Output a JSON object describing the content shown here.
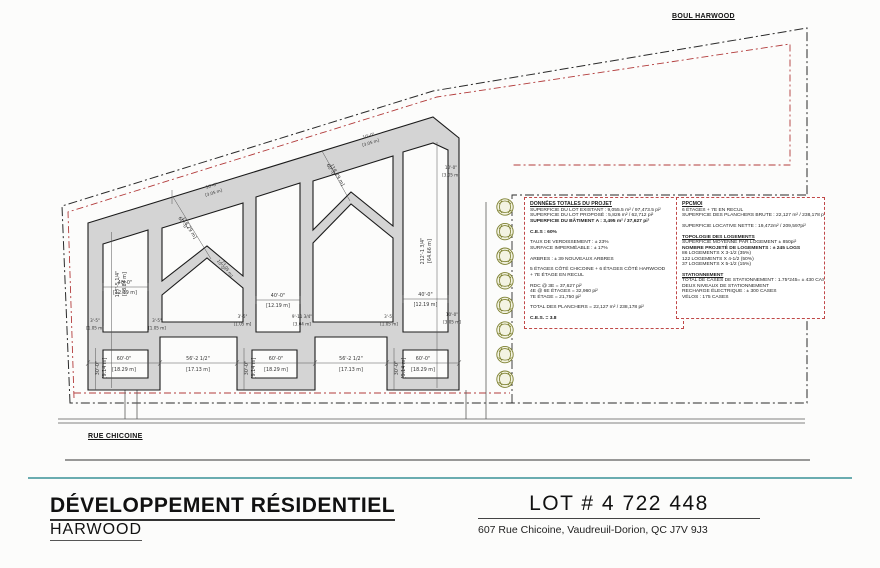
{
  "streets": {
    "harwood": "BOUL HARWOOD",
    "chicoine": "RUE CHICOINE"
  },
  "title_block": {
    "title": "DÉVELOPPEMENT RÉSIDENTIEL",
    "subtitle": "HARWOOD",
    "lot": "LOT # 4 722 448",
    "address": "607 Rue Chicoine, Vaudreuil-Dorion, QC J7V 9J3"
  },
  "colors": {
    "slab_gray": "#d4d4d4",
    "line_dark": "#1b1b1b",
    "red_line": "#b23b3b",
    "teal_line": "#6aacb0",
    "tree_olive": "#7d8030"
  },
  "info_left": {
    "title": "DONNÉES TOTALES DU PROJET",
    "lines": [
      {
        "t": "SUPERFICIE DU LOT EXISTANT : 9,055.5 m² / 97,473.5 pi²"
      },
      {
        "t": "SUPERFICIE DU LOT PROPOSÉ : 5,826 m² / 62,712 pi²"
      },
      {
        "t": "SUPERFICIE DU BÂTIMENT A : 3,495 m² / 37,627 pi²",
        "b": true
      },
      {
        "t": ""
      },
      {
        "t": "C.E.S : 60%",
        "b": true
      },
      {
        "t": ""
      },
      {
        "t": "TAUX DE VERDISSEMENT : ± 23%"
      },
      {
        "t": "SURFACE IMPERMÉABLE : ± 17%"
      },
      {
        "t": ""
      },
      {
        "t": "ARBRES : ± 39 NOUVEAUX ARBRES"
      },
      {
        "t": ""
      },
      {
        "t": "5 ÉTAGES CÔTÉ CHICOINE + 6 ÉTAGES CÔTÉ HARWOOD"
      },
      {
        "t": "+ 7E ÉTAGE EN RECUL"
      },
      {
        "t": ""
      },
      {
        "t": "RDC @ 3E = 37,627 pi²"
      },
      {
        "t": "4E @ 6E ÉTAGES = 32,960 pi²"
      },
      {
        "t": "7E ÉTAGE = 21,750 pi²"
      },
      {
        "t": ""
      },
      {
        "t": "TOTAL DES PLANCHERS = 22,127 m² / 238,178 pi²"
      },
      {
        "t": ""
      },
      {
        "t": "C.E.S. = 3.8",
        "b": true
      }
    ]
  },
  "info_right": {
    "title": "PPCMOI",
    "lines": [
      {
        "t": "6 ÉTAGES + 7E EN RECUL"
      },
      {
        "t": "SUPERFICIE DES PLANCHERS BRUTE : 22,127 m² / 238,178 pi²"
      },
      {
        "t": ""
      },
      {
        "t": "SUPERFICIE LOCATIVE NETTE : 19,472m² / 209,597pi²"
      },
      {
        "t": ""
      },
      {
        "t": "TOPOLOGIE DES LOGEMENTS",
        "b": true,
        "u": true
      },
      {
        "t": "SUPERFICIE MOYENNE PAR LOGEMENT ± 850pi²"
      },
      {
        "t": "NOMBRE PROJETÉ DE LOGEMENTS : ± 245 LOGS",
        "b": true
      },
      {
        "t": "86 LOGEMENTS X 3-1/2 (35%)"
      },
      {
        "t": "122 LOGEMENTS X 4-1/2 (50%)"
      },
      {
        "t": "37 LOGEMENTS X 5-1/2 (15%)"
      },
      {
        "t": ""
      },
      {
        "t": "STATIONNEMENT",
        "b": true,
        "u": true
      },
      {
        "t": "TOTAL DE CASES DE STATIONNEMENT : 1.75*245= ± 430 CASES"
      },
      {
        "t": "DEUX NIVEAUX DE STATIONNEMENT"
      },
      {
        "t": "RECHARGE ÉLECTRIQUE : ± 300 CASES"
      },
      {
        "t": "VÉLOS : 175 CASES"
      }
    ]
  },
  "dims": {
    "w60": {
      "ft": "60'-0\"",
      "m": "[18.29 m]"
    },
    "w56": {
      "ft": "56'-2 1/2\"",
      "m": "[17.13 m]"
    },
    "w40": {
      "ft": "40'-0\"",
      "m": "[12.19 m]"
    },
    "d30": {
      "ft": "30'-0\"",
      "m": "[9.14 m]"
    },
    "h127": {
      "ft": "127'-5 1/4\"",
      "m": "[38.84 m]"
    },
    "h212": {
      "ft": "212'-1 3/4\"",
      "m": "[64.66 m]"
    },
    "s10": {
      "ft": "10'-0\"",
      "m": "[3.05 m]"
    },
    "s3": {
      "ft": "3'-5\"",
      "m": "[1.05 m]"
    },
    "s9": {
      "ft": "9'-11 3/4\"",
      "m": "[3.04 m]"
    }
  }
}
